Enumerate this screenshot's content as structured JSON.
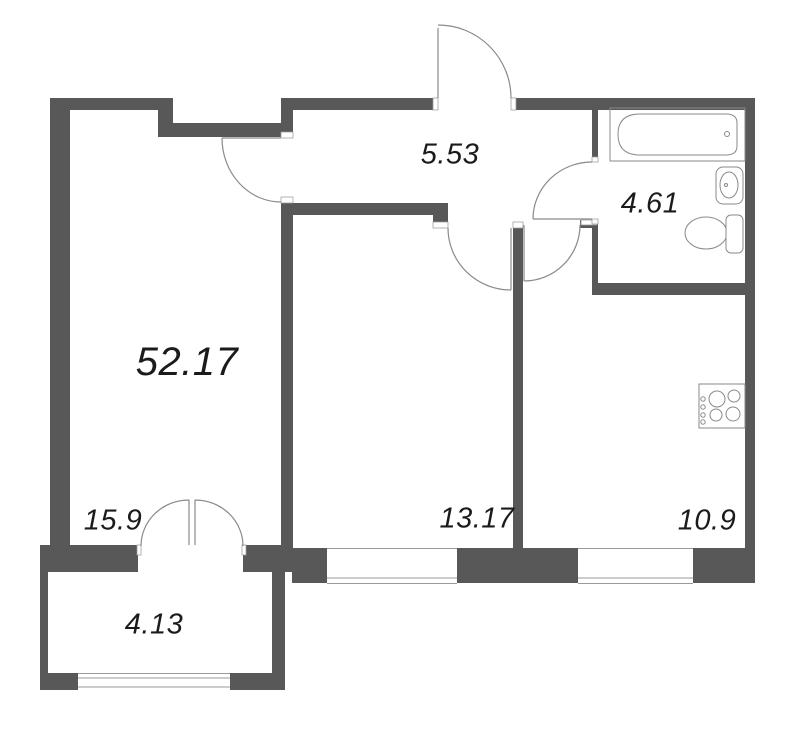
{
  "plan": {
    "type": "apartment-floor-plan",
    "total_area": {
      "value": "52.17"
    },
    "rooms": [
      {
        "id": "living-room",
        "area": "15.9"
      },
      {
        "id": "hallway",
        "area": "5.53"
      },
      {
        "id": "bathroom",
        "area": "4.61"
      },
      {
        "id": "bedroom",
        "area": "13.17"
      },
      {
        "id": "kitchen",
        "area": "10.9"
      },
      {
        "id": "balcony",
        "area": "4.13"
      }
    ],
    "fixtures": [
      "bathtub",
      "sink",
      "toilet",
      "stove-hob",
      "entrance-door",
      "living-room-door",
      "bedroom-door",
      "kitchen-door",
      "bathroom-door",
      "balcony-french-door",
      "bedroom-window",
      "kitchen-window",
      "balcony-window"
    ],
    "colors": {
      "wall": "#585858",
      "fixture_line": "#8a8a8a",
      "window_line": "#9a9a9a",
      "text": "#1b1b1b",
      "background": "#ffffff"
    }
  }
}
